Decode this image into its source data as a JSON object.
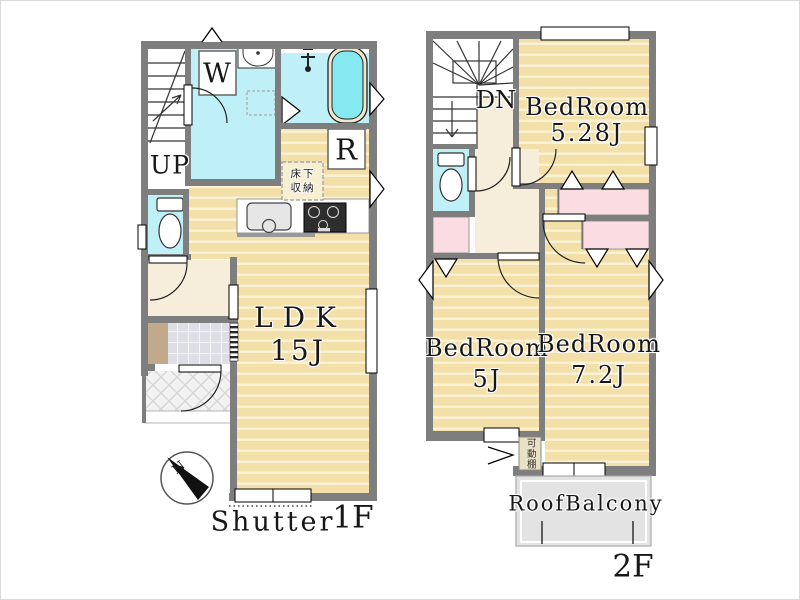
{
  "floor1": {
    "floor_label": "1F",
    "shutter_label": "Shutter",
    "stairs_label": "UP",
    "washer_label": "W",
    "fridge_label": "R",
    "ldk_name": "LDK",
    "ldk_size": "15J",
    "underfloor_storage_line1": "床下",
    "underfloor_storage_line2": "収納",
    "compass_north": "N"
  },
  "floor2": {
    "floor_label": "2F",
    "stairs_label": "DN",
    "bedroom_a_name": "BedRoom",
    "bedroom_a_size": "5.28J",
    "bedroom_b_name": "BedRoom",
    "bedroom_b_size": "5J",
    "bedroom_c_name": "BedRoom",
    "bedroom_c_size": "7.2J",
    "balcony_label": "RoofBalcony",
    "movable_shelf_label": "可動棚"
  },
  "colors": {
    "wood_floor": "#F3E0A9",
    "wood_stripe": "#FBF2D5",
    "water_room_cyan": "#BFEFF7",
    "bathtub_water": "#86E9F2",
    "closet_pink": "#FADCE2",
    "hallway_beige": "#F6EEDA",
    "wall_gray": "#7E7E7E",
    "balcony_gray": "#E3E3E3",
    "entrance_tile": "#DEDEE6",
    "shoe_cabinet_brown": "#C2A98C"
  }
}
